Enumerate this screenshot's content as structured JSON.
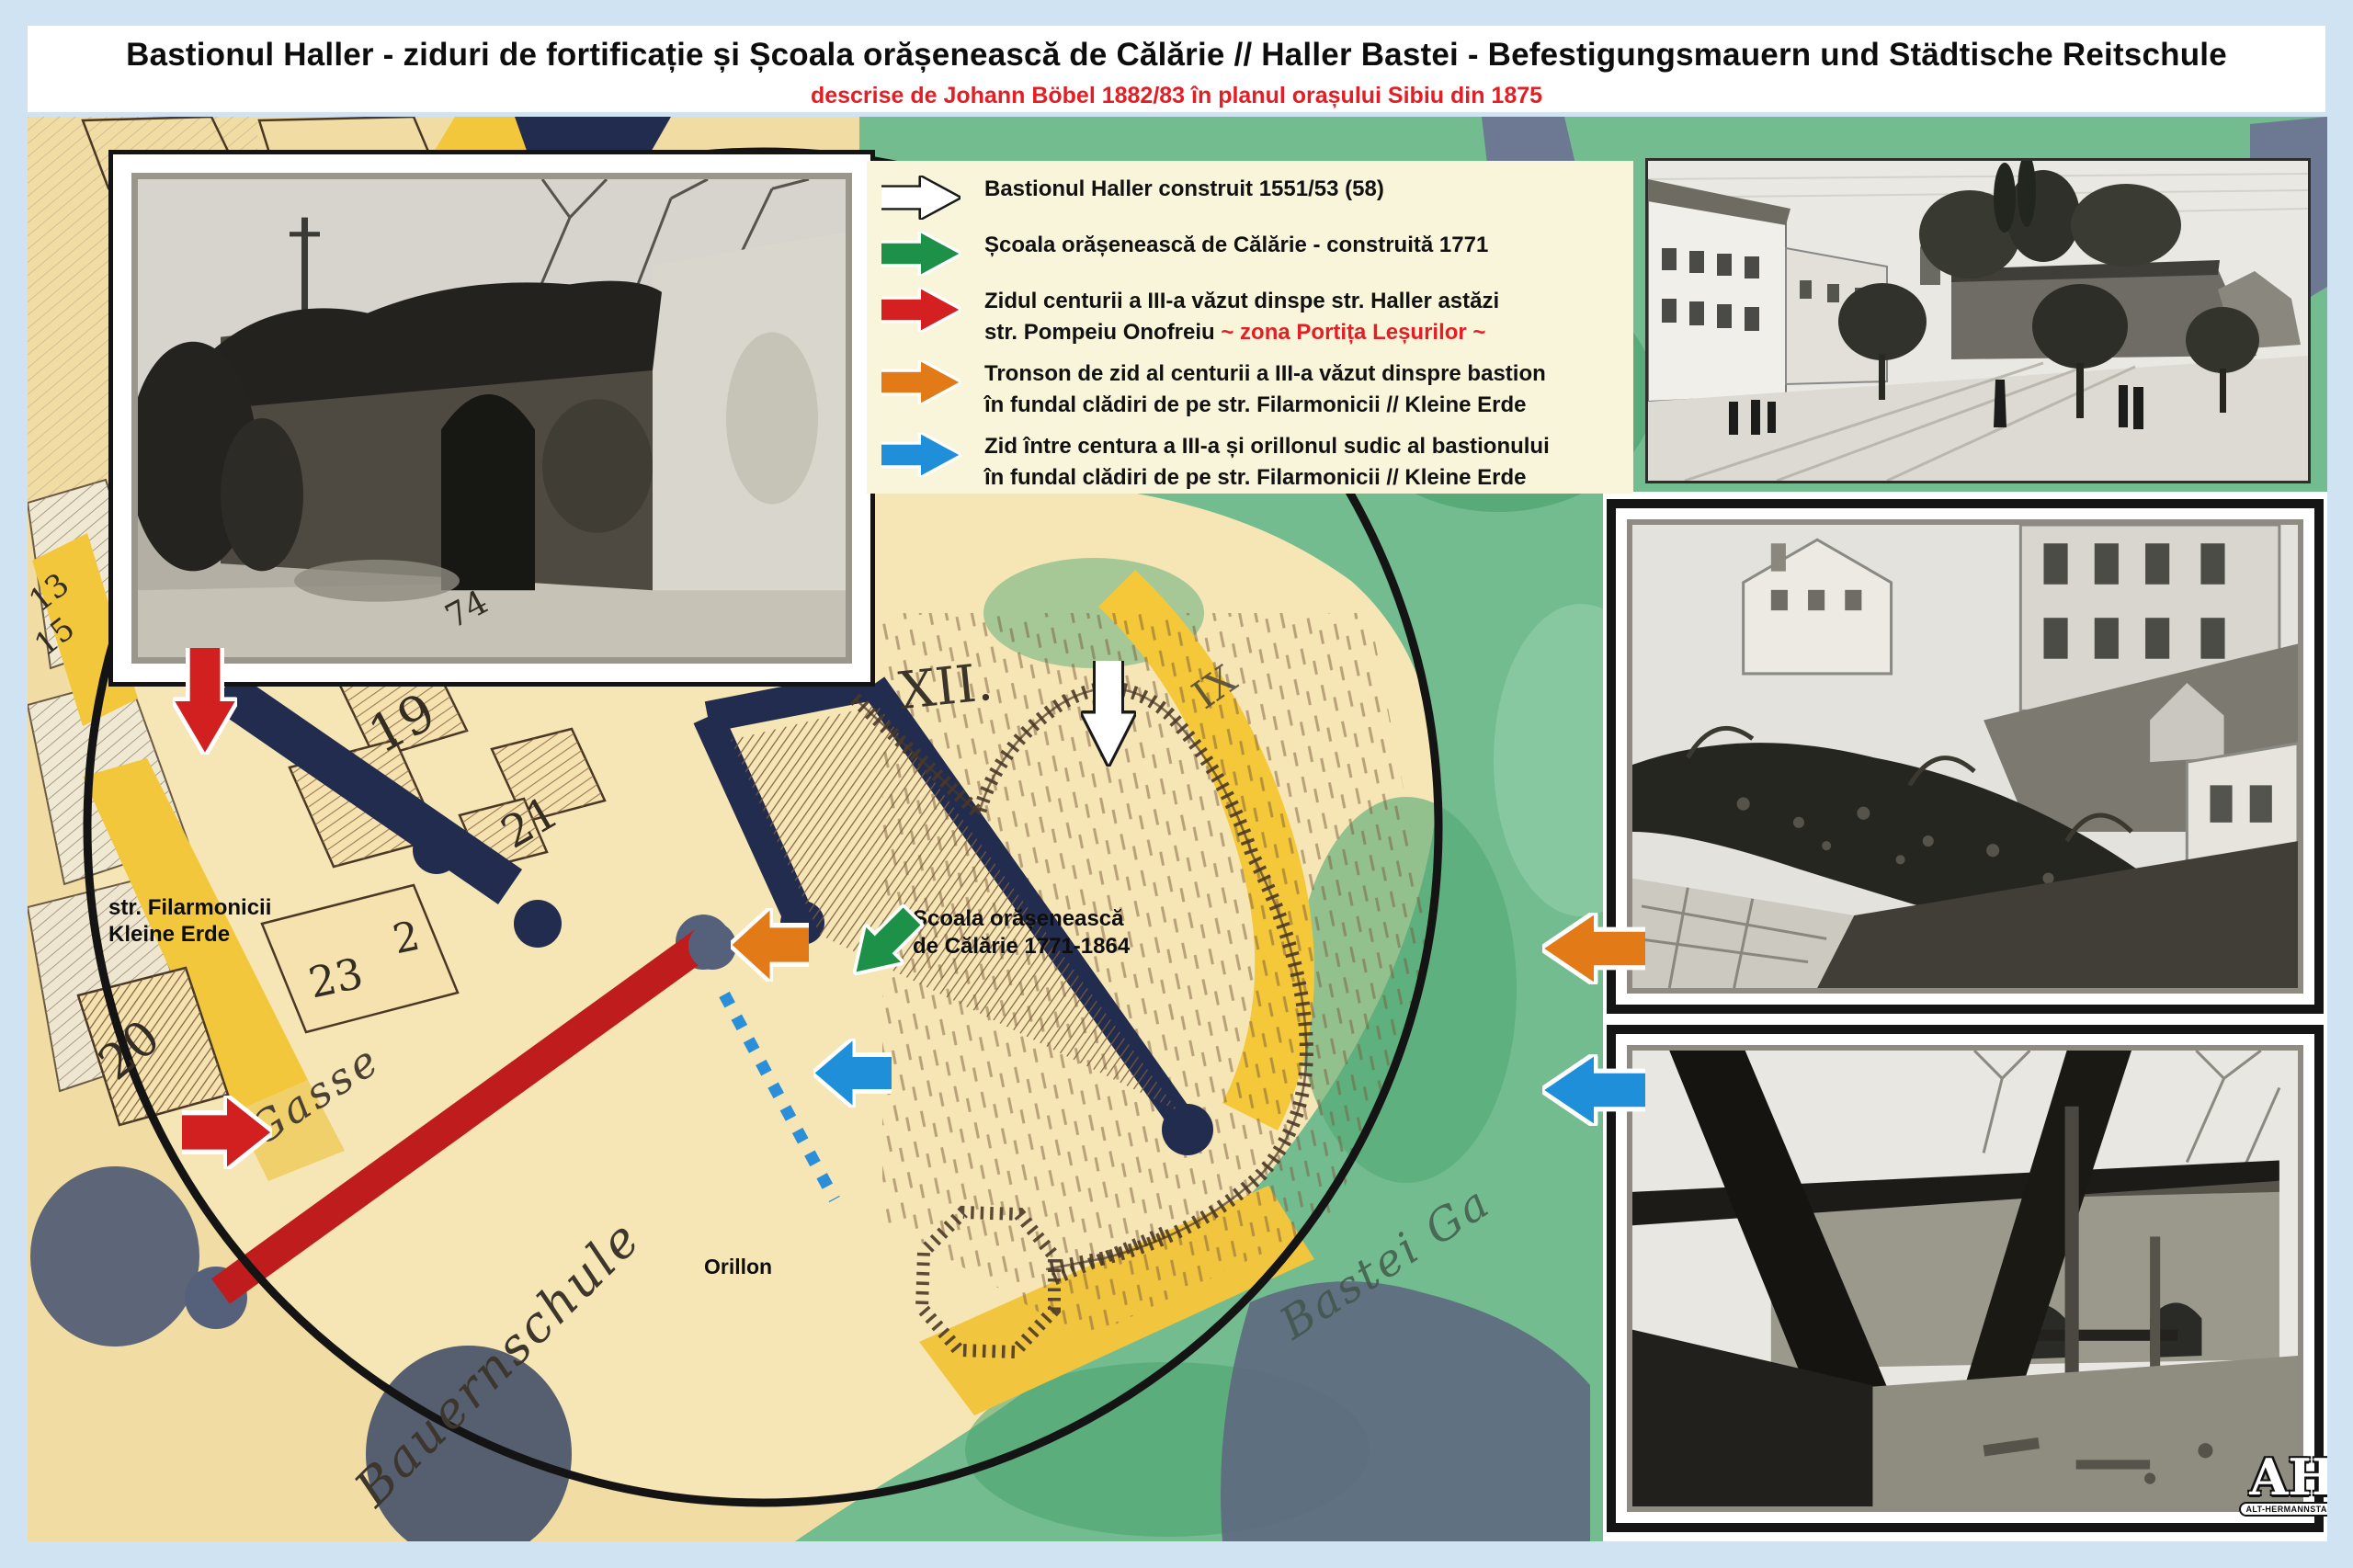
{
  "header": {
    "title": "Bastionul Haller - ziduri de fortificație și Școala orășenească de Călărie // Haller Bastei - Befestigungsmauern und Städtische Reitschule",
    "subtitle": "descrise de Johann Böbel 1882/83 în planul orașului Sibiu din 1875"
  },
  "legend": {
    "items": [
      {
        "arrow": "white-right-arrow",
        "color": "#ffffff",
        "line1": "Bastionul Haller construit 1551/53 (58)"
      },
      {
        "arrow": "green-right-arrow",
        "color": "#1d9148",
        "line1": "Școala orășenească de Călărie - construită 1771"
      },
      {
        "arrow": "red-right-arrow",
        "color": "#d42020",
        "line1": "Zidul centurii a III-a văzut dinspe str. Haller astăzi",
        "line2_black": "str. Pompeiu Onofreiu ",
        "line2_red": "~ zona Portița Leșurilor ~",
        "highlight_color": "#e31e24"
      },
      {
        "arrow": "orange-right-arrow",
        "color": "#e27a18",
        "line1": "Tronson de zid al centurii a III-a văzut dinspre bastion",
        "line2": "în fundal clădiri de pe str. Filarmonicii // Kleine Erde"
      },
      {
        "arrow": "blue-right-arrow",
        "color": "#1e8fd8",
        "line1": "Zid între centura a III-a și orillonul sudic al bastionului",
        "line2": "în fundal clădiri de pe str. Filarmonicii // Kleine Erde"
      }
    ]
  },
  "map": {
    "labels": {
      "street_ro": "str. Filarmonicii",
      "street_de": "Kleine Erde",
      "school_line1": "Școala orășenească",
      "school_line2": "de Călărie 1771-1864",
      "orillon": "Orillon",
      "district": "XII.",
      "district_small": "IX",
      "gasse": "Gasse",
      "bauernschule": "Bauernschule",
      "bastei": "Bastei Ga"
    },
    "numbers": {
      "n13": "13",
      "n15": "15",
      "n19": "19",
      "n20": "20",
      "n21": "21",
      "n23": "23",
      "n2": "2",
      "n74": "74"
    }
  },
  "logo": {
    "monogram": "AH",
    "caption": "ALT-HERMANNSTADT"
  }
}
